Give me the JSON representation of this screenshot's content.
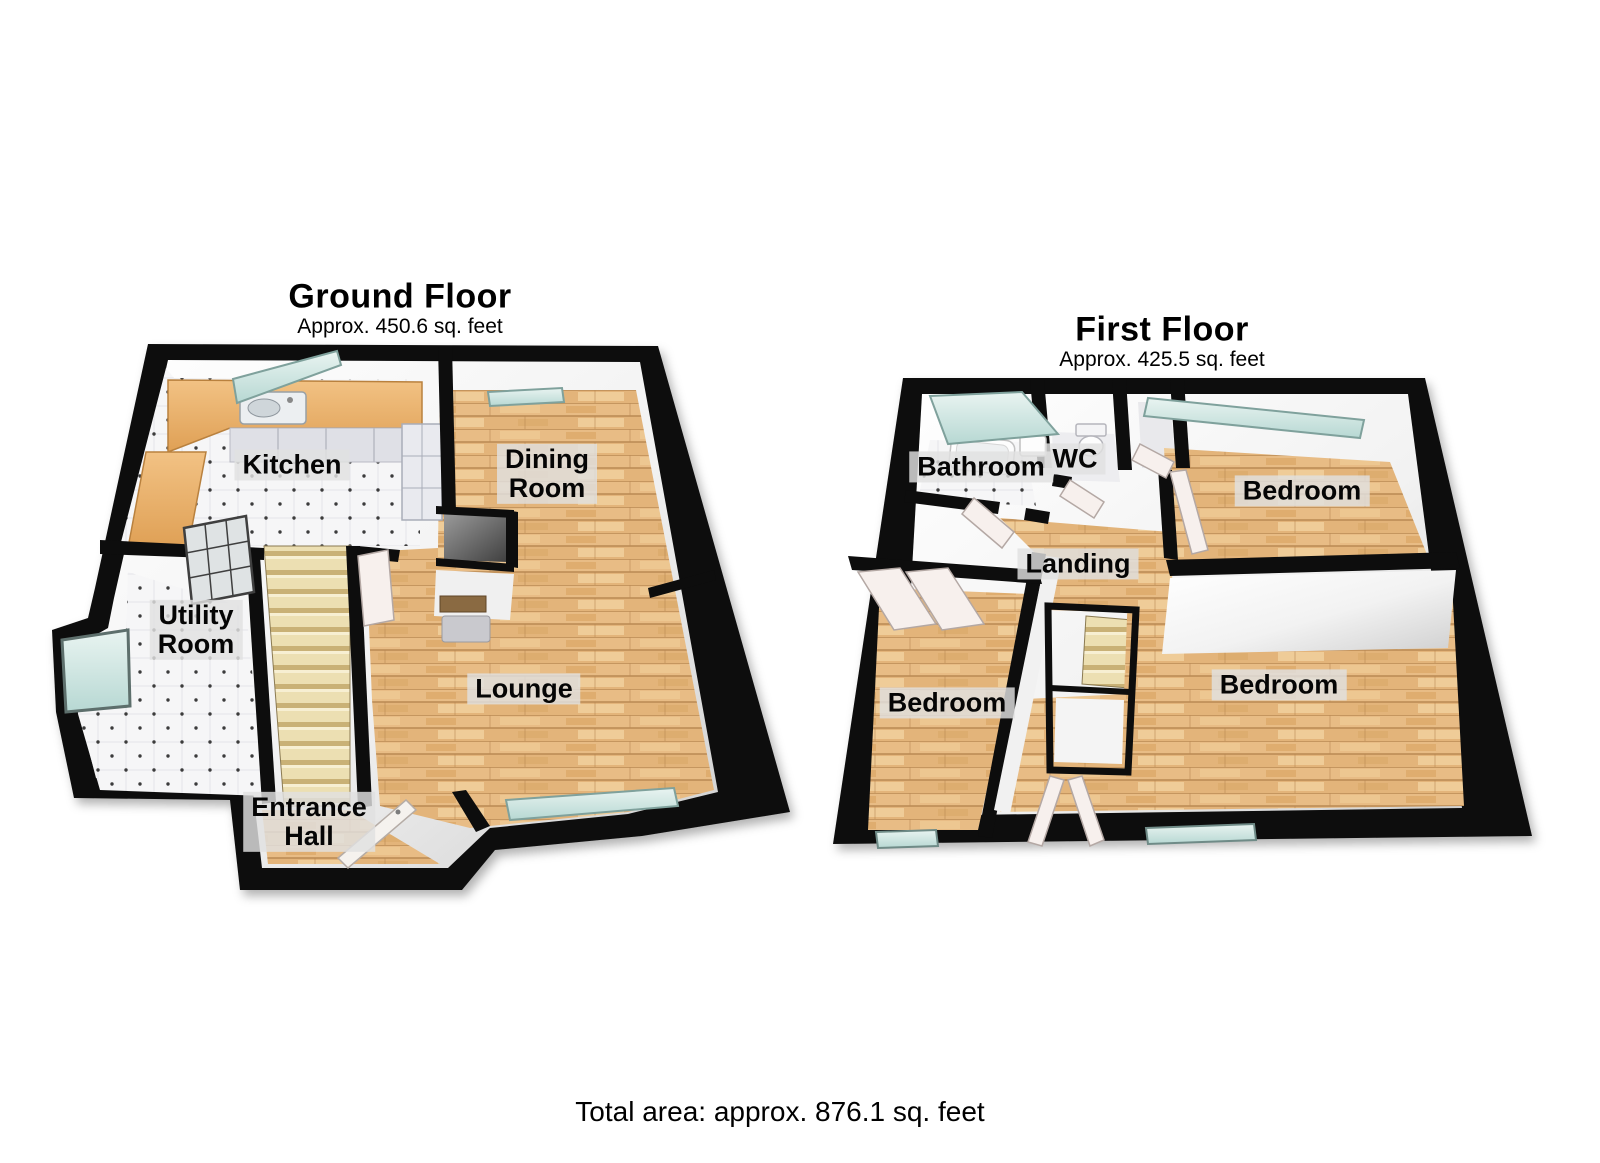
{
  "ground_floor": {
    "title": "Ground Floor",
    "area_label": "Approx. 450.6 sq. feet",
    "rooms": {
      "kitchen": "Kitchen",
      "dining_room": "Dining\nRoom",
      "utility_room": "Utility\nRoom",
      "lounge": "Lounge",
      "entrance_hall": "Entrance\nHall"
    }
  },
  "first_floor": {
    "title": "First Floor",
    "area_label": "Approx. 425.5 sq. feet",
    "rooms": {
      "bathroom": "Bathroom",
      "wc": "WC",
      "bedroom_top_right": "Bedroom",
      "landing": "Landing",
      "bedroom_bottom_left": "Bedroom",
      "bedroom_bottom_right": "Bedroom"
    }
  },
  "footer": {
    "total_area": "Total area: approx. 876.1 sq. feet"
  },
  "colors": {
    "wall": "#0d0d0d",
    "wall_face_light": "#ffffff",
    "wall_face_shade": "#cfcfcf",
    "wood_floor": "#e8bc85",
    "wood_grain": "#b98952",
    "tile_floor": "#f6f6f7",
    "tile_dot": "#3c3c3c",
    "stairs": "#ecdfb2",
    "stair_riser": "#c9b176",
    "window_glass": "#cfe7e3",
    "counter": "#e8ab60",
    "cabinet": "#dfe0e6",
    "door": "#f7f0ed",
    "label_background": "#e1e1e1",
    "text": "#000000"
  }
}
